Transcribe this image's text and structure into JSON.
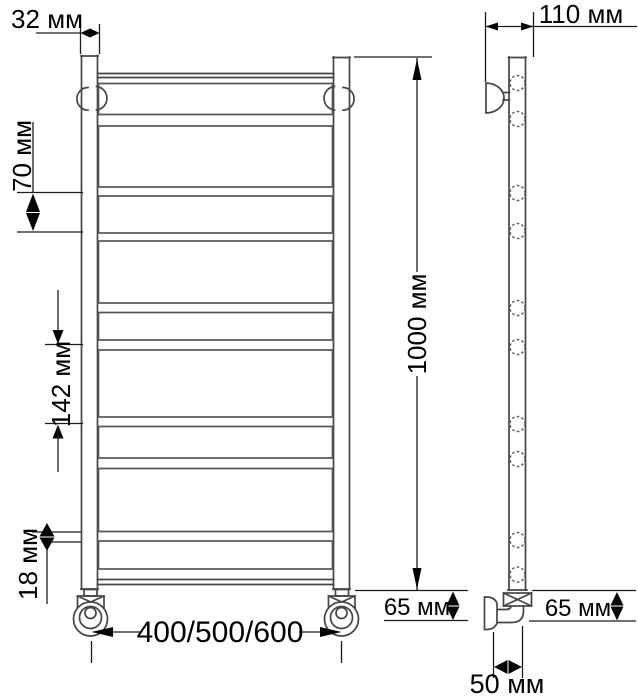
{
  "labels": {
    "tube_diameter": "32 мм",
    "depth": "110 мм",
    "rung_gap_70": "70 мм",
    "rung_gap_142": "142 мм",
    "rung_gap_18": "18 мм",
    "height": "1000 мм",
    "width_options": "400/500/600",
    "bottom_offset_front": "65 мм",
    "bottom_offset_side": "65 мм",
    "wall_offset": "50 мм"
  },
  "front_view": {
    "rung_x": 98.5,
    "rung_w": 234,
    "rungs": [
      {
        "y": 83.5,
        "h": 31
      },
      {
        "y": 126,
        "h": 61
      },
      {
        "y": 196,
        "h": 37
      },
      {
        "y": 241,
        "h": 62
      },
      {
        "y": 312.5,
        "h": 27.5
      },
      {
        "y": 350,
        "h": 67
      },
      {
        "y": 426.5,
        "h": 31.5
      },
      {
        "y": 468.5,
        "h": 63
      },
      {
        "y": 541,
        "h": 28
      }
    ]
  },
  "side_view": {
    "hole_cx": 517.5,
    "hole_r": 7.5,
    "holes_y": [
      83,
      119,
      193,
      231,
      308,
      347,
      424,
      459,
      540,
      574.5
    ]
  },
  "colors": {
    "line": "#454545",
    "dimension": "#1c1c1c",
    "text": "#000000",
    "background": "#ffffff"
  }
}
